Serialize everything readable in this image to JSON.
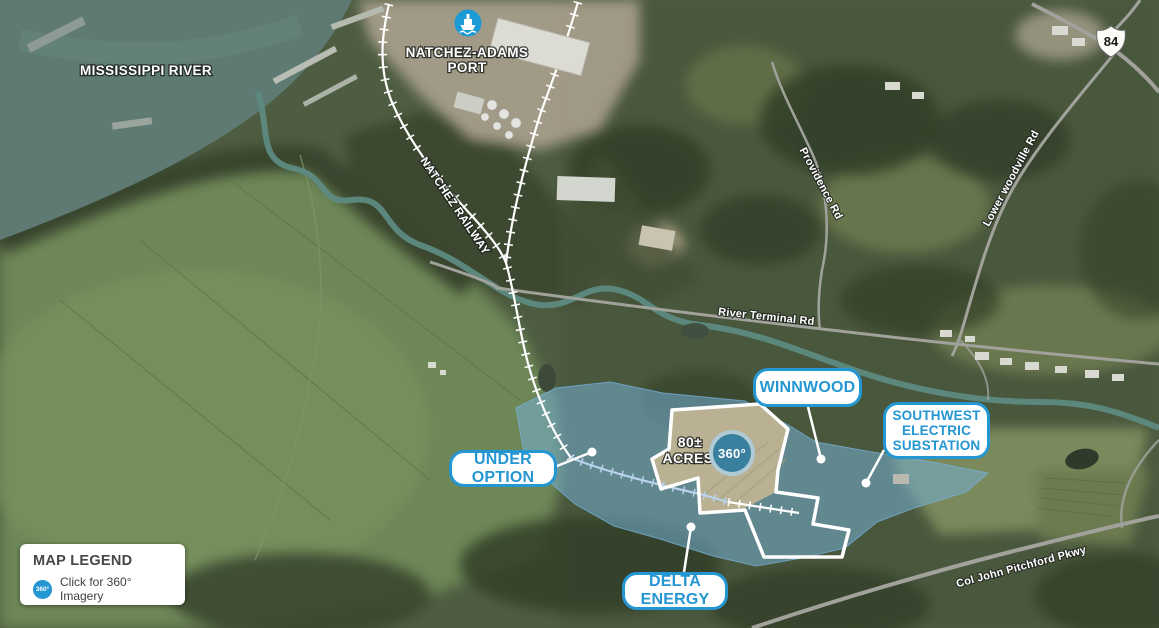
{
  "labels": {
    "mississippi_river": "MISSISSIPPI RIVER",
    "port_line1": "NATCHEZ-ADAMS",
    "port_line2": "PORT",
    "natchez_railway": "NATCHEZ RAILWAY",
    "providence_rd": "Providence Rd",
    "river_terminal_rd": "River Terminal Rd",
    "lower_woodville_rd": "Lower woodville Rd",
    "col_john_pitchford_pkwy": "Col John Pitchford Pkwy",
    "highway_84": "84"
  },
  "callouts": {
    "winnwood": {
      "label": "WINNWOOD"
    },
    "southwest_substation": {
      "line1": "SOUTHWEST",
      "line2": "ELECTRIC",
      "line3": "SUBSTATION"
    },
    "under_option": {
      "label": "UNDER OPTION"
    },
    "delta_energy": {
      "label": "DELTA ENERGY"
    }
  },
  "site": {
    "acreage_line1": "80±",
    "acreage_line2": "ACRES",
    "view_360": "360°"
  },
  "legend": {
    "title": "MAP LEGEND",
    "icon_label": "360°",
    "item": "Click for 360° Imagery"
  },
  "colors": {
    "callout_blue": "#2496d2",
    "site_overlay_fill": "#74aed3",
    "river_teal": "#5e7a73",
    "button_360": "#38809e"
  }
}
